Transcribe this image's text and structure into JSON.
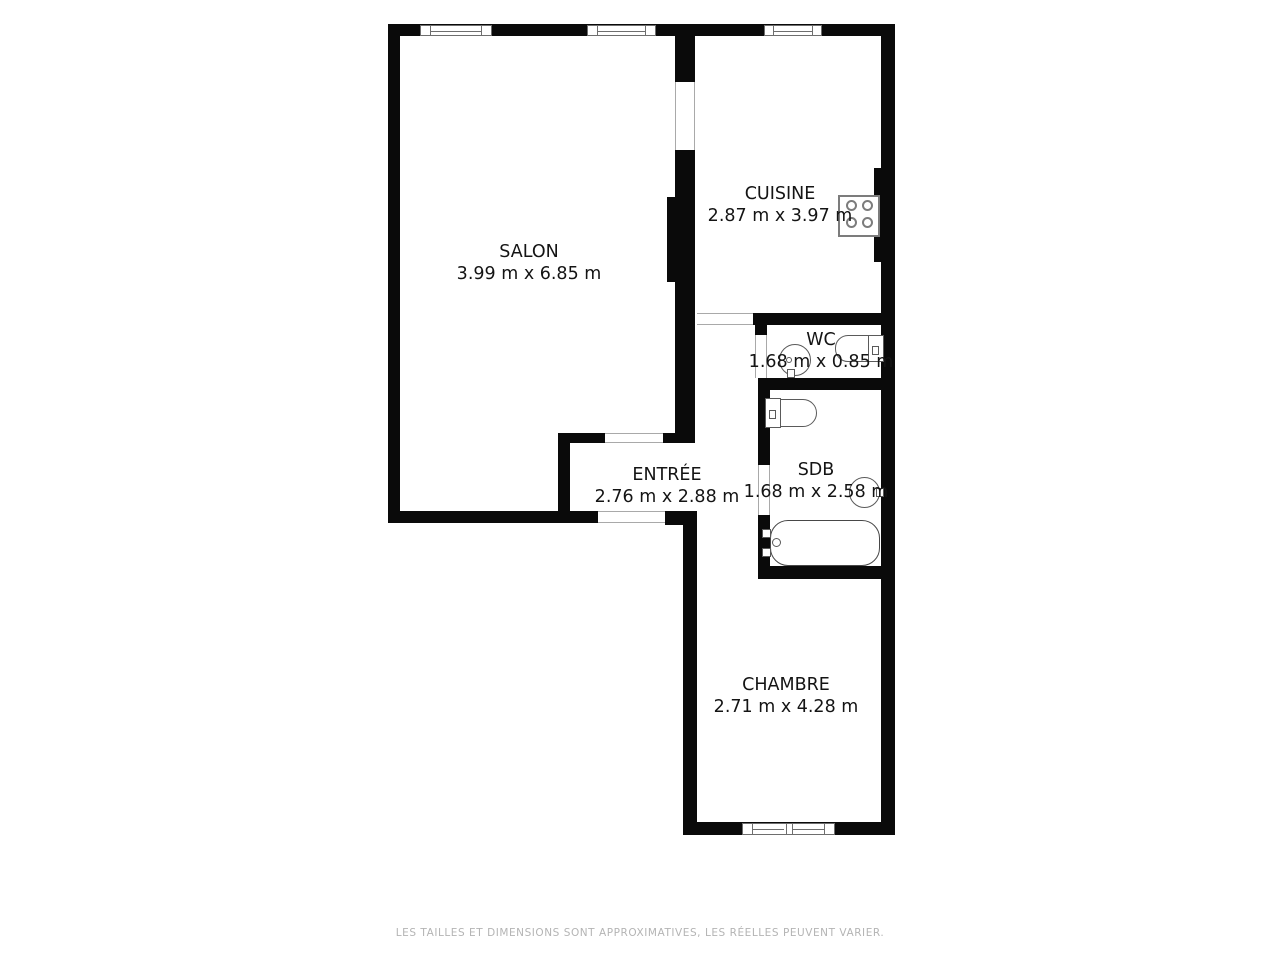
{
  "floorplan": {
    "wall_color": "#0a0a0a",
    "opening_line_color": "#a9a9a9",
    "label_color": "#141414",
    "rooms": [
      {
        "id": "salon",
        "name": "SALON",
        "dimensions": "3.99 m x 6.85 m"
      },
      {
        "id": "cuisine",
        "name": "CUISINE",
        "dimensions": "2.87 m x 3.97 m"
      },
      {
        "id": "wc",
        "name": "WC",
        "dimensions": "1.68 m x 0.85 m"
      },
      {
        "id": "sdb",
        "name": "SDB",
        "dimensions": "1.68 m x 2.58 m"
      },
      {
        "id": "entree",
        "name": "ENTRÉE",
        "dimensions": "2.76 m x 2.88 m"
      },
      {
        "id": "chambre",
        "name": "CHAMBRE",
        "dimensions": "2.71 m x 4.28 m"
      }
    ],
    "fixtures": [
      "stove-icon",
      "wc-sink-icon",
      "wc-toilet-icon",
      "sdb-toilet-icon",
      "sdb-sink-icon",
      "bathtub-icon"
    ],
    "windows_count": 4
  },
  "footer": {
    "note": "LES TAILLES ET DIMENSIONS SONT APPROXIMATIVES, LES RÉELLES PEUVENT VARIER.",
    "color": "#b4b4b4"
  }
}
